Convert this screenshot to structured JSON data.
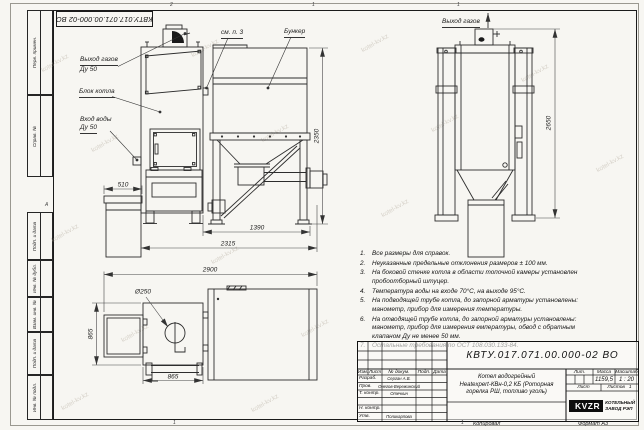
{
  "watermark": {
    "text": "kotel-kv.kz"
  },
  "frame": {
    "stamp": "КВТУ.017.071.00.000-02 ВО",
    "left_labels": [
      "Перв. примен.",
      "Справ. №",
      "Подп. и дата",
      "Инв. № дубл.",
      "Взам. инв. №",
      "Подп. и дата",
      "Инв. № подл."
    ],
    "zones_top": [
      "2",
      "1",
      "1"
    ],
    "zones_bottom": [
      "1",
      "1"
    ],
    "zone_left": "А"
  },
  "callouts": {
    "front_gas_out": "Выход газов",
    "front_gas_out_dn": "Ду 50",
    "boiler_block": "Блок котла",
    "water_in": "Вход воды",
    "water_in_dn": "Ду 50",
    "see_item3": "см. п. 3",
    "bunker": "Бункер",
    "side_gas_out": "Выход газов"
  },
  "dimensions": {
    "ash_width": "510",
    "bunker_height": "2350",
    "feed_width": "1390",
    "overall_width_front": "2315",
    "overall_height_side": "2650",
    "overall_width_top": "2900",
    "chimney_dia": "Ø250",
    "boiler_depth": "865",
    "boiler_width": "865"
  },
  "notes": {
    "items": [
      {
        "num": "1.",
        "text": "Все размеры для справок."
      },
      {
        "num": "2.",
        "text": "Неуказанные предельные отклонения размеров ± 100 мм."
      },
      {
        "num": "3.",
        "text": "На боковой стенке котла в области топочной камеры установлен пробоотборный штуцер."
      },
      {
        "num": "4.",
        "text": "Температура воды на входе 70°С, на выходе 95°С."
      },
      {
        "num": "5.",
        "text": "На подводящей трубе котла, до запорной арматуры установлены: манометр, прибор для измерения температуры."
      },
      {
        "num": "6.",
        "text": "На отводящей трубе котла, до запорной арматуры установлены: манометр, прибор для измерения емпературы, обвод с обратным клапаном Ду не менее 50 мм."
      },
      {
        "num": "7.",
        "text": "Остальные требования по ОСТ 108.030.133-84."
      }
    ]
  },
  "title_block": {
    "doc_number": "КВТУ.017.071.00.000-02 ВО",
    "product_title_lines": [
      "Котел водогрейный",
      "Heatexpert-КВн-0,2 КБ (Роторная",
      "горелка РШ, топливо уголь)"
    ],
    "rev_headers": {
      "izm": "Изм.",
      "list": "Лист",
      "doc": "№ докум.",
      "sign": "Подп.",
      "date": "Дата"
    },
    "roles": [
      {
        "label": "Разраб.",
        "name": "Серган А.В."
      },
      {
        "label": "Пров.",
        "name": "Онегов-Вережинский"
      },
      {
        "label": "Т. контр.",
        "name": "Отечкин"
      },
      {
        "label": "Н. контр.",
        "name": ""
      },
      {
        "label": "Утв.",
        "name": "Поликарпова"
      }
    ],
    "lit_label": "Лит.",
    "mass_label": "Масса",
    "scale_label": "Масштаб",
    "mass_value": "1159,5",
    "scale_value": "1 : 20",
    "sheet_label": "Лист",
    "sheets_label": "Листов",
    "sheets_value": "1",
    "logo": {
      "mark": "KVZR",
      "caption1": "КОТЕЛЬНЫЙ",
      "caption2": "ЗАВОД РЭП"
    },
    "copied": "Копировал",
    "format": "Формат А3"
  }
}
